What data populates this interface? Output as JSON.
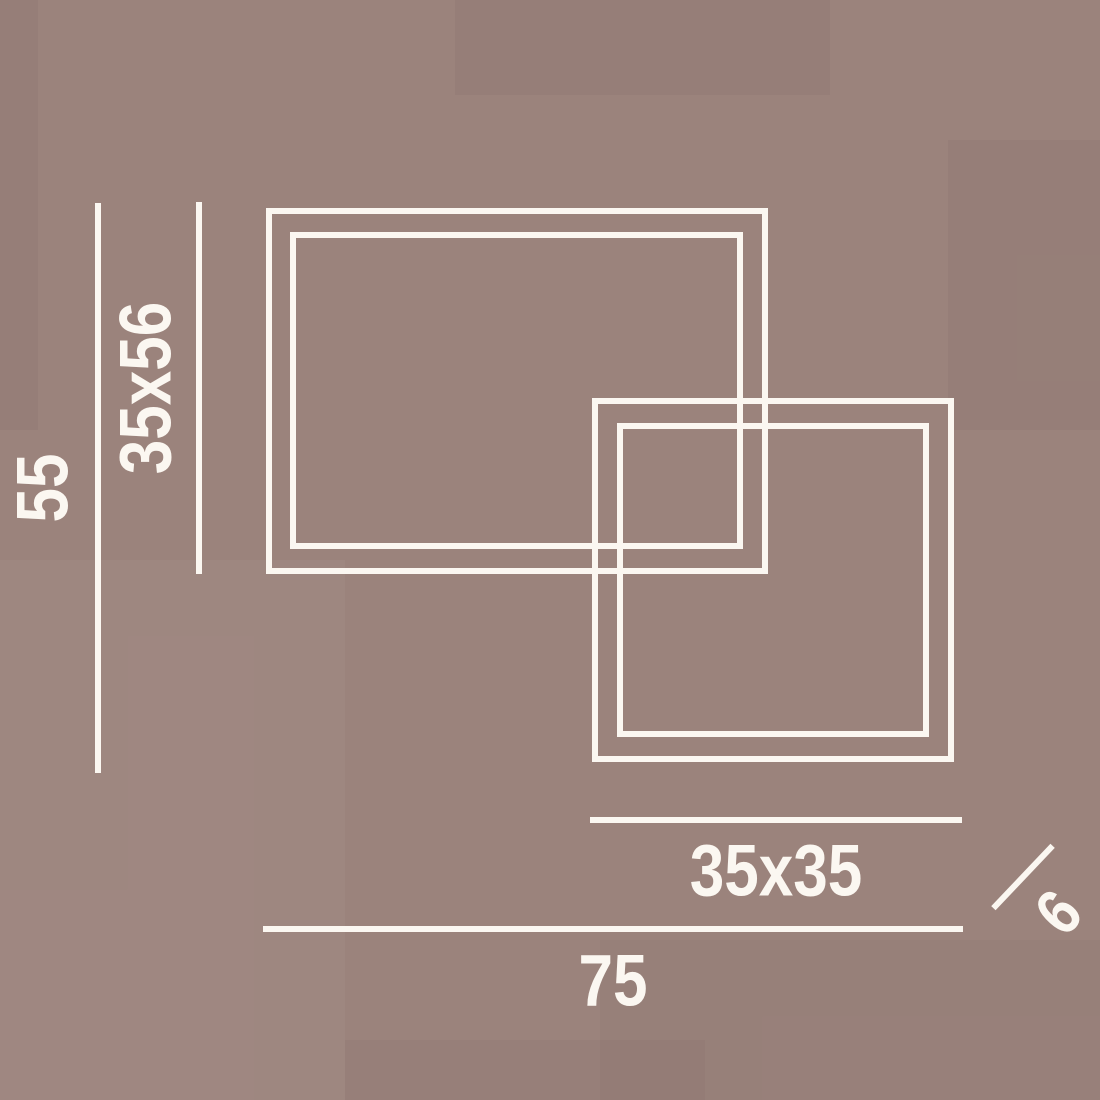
{
  "colors": {
    "background": "#9b837c",
    "ink": "#fbf7f1"
  },
  "diagram": {
    "description": "Dimension drawing of a ceiling light made of two overlapping square frames, each frame drawn as a double white outline on a mauve background"
  },
  "labels": {
    "total_height": "55",
    "large_frame_size": "35x56",
    "small_frame_size": "35x35",
    "total_width": "75",
    "depth": "6"
  }
}
